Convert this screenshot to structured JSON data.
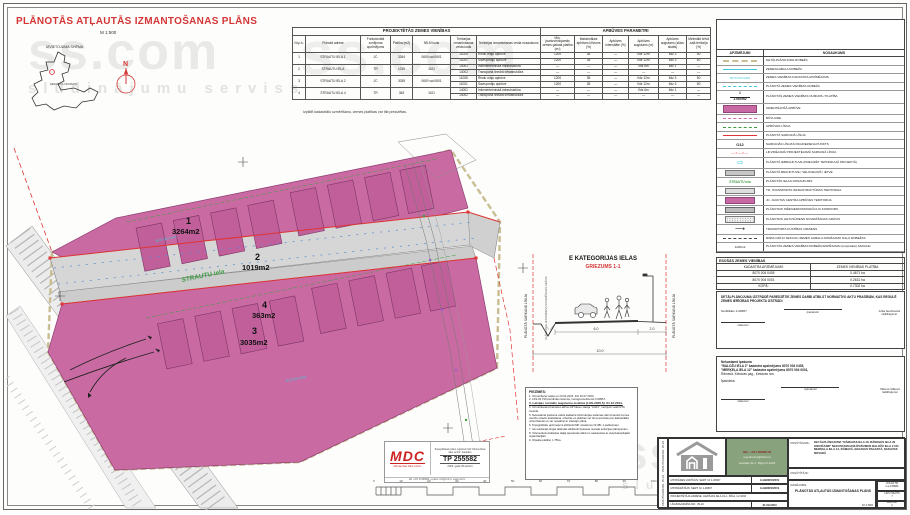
{
  "watermark": {
    "brand": "ss.com",
    "tagline": "sludinājumu serviss"
  },
  "header": {
    "title": "PLĀNOTĀS ATĻAUTĀS IZMANTOŠANAS PLĀNS",
    "scale": "M 1:500",
    "location_schema_label": "IZVIETOJUMA SHĒMA",
    "municipality_label": "ĶEKAVAS NOVADS",
    "north_label": "N"
  },
  "projected_table": {
    "title": "PROJEKTĒTĀS ZEMES VIENĪBAS",
    "params_title": "APBŪVES PARAMETRI",
    "columns": [
      "Nr.p.k.",
      "Plānotā adrese",
      "Funkcionālā zonējuma apzīmējums",
      "Platība (m2)",
      "NĪLM kods",
      "Teritorijas izmantošanas veida kods",
      "Teritorijas izmantošanas veida nosaukums"
    ],
    "param_columns": [
      "Min. jaunizveidojamās zemes gabala platība (m²)",
      "Maksimālais apbūves blīvums (%)",
      "Apbūves intensitāte (%)",
      "Apbūves augstums (m)",
      "Apbūves augstums (stāvu skaits)",
      "Minimālā brīvā zaļā teritorija (%)"
    ],
    "rows": [
      {
        "nr": "1",
        "adrese": "STRAUTU IELA 1",
        "zona": "JC",
        "platiba": "3264",
        "nilm": "0600 vai 0601",
        "lines": [
          [
            "11005",
            "Rindu māju apbūve",
            "1200",
            "35",
            "—",
            "līdz 12m",
            "līdz 3",
            "50"
          ],
          [
            "11001",
            "Savrupmāju apbūve",
            "1200",
            "35",
            "—",
            "līdz 12m",
            "līdz 3",
            "50"
          ]
        ]
      },
      {
        "nr": "2",
        "adrese": "STRAUTU IELA",
        "zona": "TR",
        "platiba": "1019",
        "nilm": "1101",
        "lines": [
          [
            "14001",
            "Inženiertehniskā infrastruktūra",
            "—",
            "—",
            "—",
            "līdz 6m",
            "līdz 1",
            "—"
          ],
          [
            "14002",
            "Transporta lineārā infrastruktūra",
            "—",
            "—",
            "—",
            "—",
            "—",
            "—"
          ]
        ]
      },
      {
        "nr": "3",
        "adrese": "STRAUTU IELA 2",
        "zona": "JC",
        "platiba": "3035",
        "nilm": "0600 vai 0601",
        "lines": [
          [
            "11005",
            "Rindu māju apbūve",
            "1200",
            "35",
            "—",
            "līdz 12m",
            "līdz 3",
            "50"
          ],
          [
            "11001",
            "Savrupmāju apbūve",
            "1200",
            "35",
            "—",
            "līdz 12m",
            "līdz 3",
            "50"
          ]
        ]
      },
      {
        "nr": "4",
        "adrese": "STRAUTU IELA 4",
        "zona": "TR",
        "platiba": "363",
        "nilm": "1101",
        "lines": [
          [
            "14001",
            "Inženiertehniskā infrastruktūra",
            "—",
            "—",
            "—",
            "līdz 6m",
            "līdz 1",
            "—"
          ],
          [
            "14002",
            "Transporta lineārā infrastruktūra",
            "—",
            "—",
            "—",
            "—",
            "—",
            "—"
          ]
        ]
      }
    ],
    "footnote": "Izpildīt kadastrālo uzmērīšanu, zemes platības var tikt precizētas."
  },
  "legend": {
    "col_symbol": "APZĪMĒJUMI",
    "col_name": "NOSAUKUMS",
    "items": [
      {
        "sym": "dash-olive",
        "label": "DETĀLPLĀNOJUMA ROBEŽA"
      },
      {
        "sym": "line-cyan",
        "label": "ZEMESGABALA ROBEŽA"
      },
      {
        "sym": "text-cyan",
        "text": "8070 004 0405",
        "label": "ZEMES VIENĪBAS KADASTRA APZĪMĒJUMS"
      },
      {
        "sym": "dash-cyan",
        "label": "PLĀNOTĀ ZEMES VIENĪBAS ROBEŽA"
      },
      {
        "sym": "num-area",
        "text": "1",
        "text2": "1.060m2",
        "label": "PLĀNOTĀS ZEMES VIENĪBAS NUMURS / PLATĪBA"
      },
      {
        "sym": "rect-pink-big",
        "label": "ORIENTĒJOŠĀ APBŪVE"
      },
      {
        "sym": "dash-pink",
        "label": "BŪVLAIDE"
      },
      {
        "sym": "dashdot-green",
        "label": "APBŪVES LĪNIJA"
      },
      {
        "sym": "line-red",
        "label": "PLĀNOTĀ SARKANĀ LĪNIJA"
      },
      {
        "sym": "text-red",
        "text": "O12",
        "label": "SARKANĀS LĪNIJAS PAGRIEZIENA PUNKTS"
      },
      {
        "sym": "xdash-red",
        "text": "—×—×—",
        "label": "LIKVIDĒJAMĀ PROJEKTĒJAMĀ SARKANĀ LĪNIJA"
      },
      {
        "sym": "arrow-cyan",
        "text": "⇨",
        "label": "PLĀNOTĀ IEBRAUKTUVE (PRECIZĒT TEHNISKAJĀ PROJEKTĀ)"
      },
      {
        "sym": "rect-gray",
        "label": "PLĀNOTĀ BRAUKTUVE / VELOCELIŅŠ / IETVE"
      },
      {
        "sym": "text-green",
        "text": "STRAUTU iela",
        "label": "PLĀNOTĀS IELAS NOSAUKUMS"
      },
      {
        "sym": "rect-lightgray",
        "label": "TR, TRANSPORTA INFRASTRUKTŪRAS TERITORIJA"
      },
      {
        "sym": "rect-pink",
        "label": "JC, JAUKTAS CENTRA APBŪVES TERITORIJA"
      },
      {
        "sym": "rect-midgray",
        "label": "PLĀNOTAIS INŽENIERKOMUNIKĀCIJU KORIDORS"
      },
      {
        "sym": "rect-dotted",
        "label": "PLĀNOTAIS LIETUSŪDENS NOVADĪŠANAS GRĀVIS"
      },
      {
        "sym": "arrow-black",
        "text": "⟶",
        "label": "TRANSPORTA KUSTĪBAS VIRZIENS"
      },
      {
        "sym": "dash-black",
        "label": "RINDU MĀJU SEKCIJU ZEMES GABALA DOMĀJAMO DAĻU ROBEŽAS"
      },
      {
        "sym": "text-small",
        "text": "1200m2",
        "label": "PLĀNOTĀS ZEMES VIENĪBAS ROBEŽA IESPĒJAMAI (turpmākai) SADALEI"
      }
    ]
  },
  "existing_table": {
    "title": "ESOŠĀS ZEMES VIENĪBAS",
    "columns": [
      "KADASTRA APZĪMĒJUMS",
      "ZEMES VIENĪBAS PLATĪBA"
    ],
    "rows": [
      [
        "8070 004 0405",
        "0.4671 ha"
      ],
      [
        "8070 004 0001",
        "0.2631 ha"
      ],
      [
        "KOPĀ:",
        "0.7302 ha"
      ]
    ]
  },
  "statement_box": {
    "text": "DETĀLPLĀNOJUMA IZSTRĀDĒ PAREDZĒTIE ZEMES DARBI ATBILST NORMATĪVO AKTU PRASĪBĀM, KAS REGULĒ ZEMES IERĪCĪBAS PROJEKTA IZSTRĀDI",
    "certificate": "Sertifikāts 1-00667",
    "sign_label": "/paraksts/",
    "name": "Arita Gedrovica",
    "name_label": "/atšifrējums/",
    "date_label": "/datums/"
  },
  "owner_box": {
    "line1": "Nekustamā īpašuma",
    "line2": "\"BALOŽU IELA 2\" kadastra apzīmējums 8070 004 0405,",
    "line3": "\"MERĶEĻA IELA 12\" kadastra apzīmējums 8070 004 0001,",
    "line4": "Rāmavā, Ķekavas pag., Ķekavas nov.",
    "line5": "Īpašnieks:",
    "sign_label": "/paraksts/",
    "name": "Viktors Vilkovs",
    "name_label": "/atšifrējums/",
    "date_label": "/datums/"
  },
  "plan": {
    "parcels": [
      {
        "nr": "1",
        "area": "3264m2"
      },
      {
        "nr": "2",
        "area": "1019m2"
      },
      {
        "nr": "3",
        "area": "3035m2"
      },
      {
        "nr": "4",
        "area": "363m2"
      }
    ],
    "street_name": "STRAUTU iela",
    "cadastre_labels": [
      "8070 004 0405",
      "8070 004 0001"
    ]
  },
  "section": {
    "title": "E KATEGORIJAS IELAS",
    "subtitle": "GRIEZUMS 1-1",
    "red_line_label": "PLĀNOTĀ SARKANĀ LĪNIJA",
    "ditch_label": "PLĀNOTAIS LIETUSŪDENS NOVADĪŠANAS GRĀVIS",
    "dims": {
      "carriageway": "6.0",
      "side": "2.0",
      "total": "10.0"
    }
  },
  "notes": {
    "title": "PIEZĪMES:",
    "items": [
      "Uzmērīšana veikta no 23.02.2023. līdz 16.07.2023.",
      "LKS-92 TM koordinātu sistēma, mēroga koeficients 0.99957.",
      "Latvijas normālo augstumu sistēma (LAS-2000,5). 01.12.2014.",
      "Uzmērīšanā izmantota LatPos GP bāzes stacija \"LG04\", mērījumi veikti RTK metodē.",
      "Nekustamā īpašuma valsts kadastra informācijas sistēmas dati izmantoti zemes vienību robežu attēlošanai, robežas un platības var tikt precizētas pēc kadastrālās uzmērīšanas un var nesakrist ar situāciju plānā.",
      "Topogrāfiskie apzīmējumi atbilstoši MK noteikumu Nr.281 1.pielikumam.",
      "Ielu sarkanās līnijas attēlotas atbilstoši Ķekavas novada teritorijas plānojumam.",
      "Inženierkomunikācijas daļēji apsekotas dabā un saskaņotas ar ekspluatējošajām organizācijām.",
      "Objekta platība: 1.75ha."
    ]
  },
  "stamp": {
    "logo": "MDC",
    "logo_sub": "Mērniecības Datu Centrs",
    "reg_text": "Topogrāfiskais plāns reģistrēts SIA \"Mērniecības datu centrs\" datubāzē",
    "number": "TP 255582",
    "date": "2023. gada 06.oktobrī",
    "contact": "tālr. +371 67496833, e-pasts: info@mdc.lv, www.mdc.lv"
  },
  "scalebar": {
    "labels": [
      "0",
      "10",
      "20",
      "30",
      "40",
      "50",
      "60",
      "70",
      "80",
      "90",
      "100 m"
    ]
  },
  "titleblock": {
    "side_label": "PASŪTĪJUMA NR. 35-24",
    "contact": {
      "line1": "tālr.: +371 29326143",
      "line2": "a.gedrovics@inbox.lv",
      "line3": "Liepājas 31-1, Rīga LV-1002"
    },
    "rows": [
      {
        "label": "IZSTRĀDES VADĪTĀJS: SERT. Nr 1-00667",
        "value": "A.GEDROVICS"
      },
      {
        "label": "IZSTRĀDĀTĀJS: SERT. Nr 1-00667",
        "value": "A.GEDROVICS"
      },
      {
        "label": "PROJEKTĒTĀJA ADRESE: LIEPĀJAS IELA 31-1, RĪGA, LV-1002",
        "value": ""
      },
      {
        "label": "LĪGUMA/ARHĪVA NR.: 35-24",
        "value": "31.09.2024"
      }
    ],
    "order_label": "PASŪTĪJUMS:",
    "order_text": "DETĀLPLĀNOJUMA \"RĀMAVAS IELA 18, RĀMAVAS IELA 20 GROZĪJUMI\" NEKUSTAMAJOS ĪPAŠUMOS BALOŽU IELA 2 UN MERĶEĻA IELA 12, RĀMAVĀ, ĶEKAVAS PAGASTĀ, ĶEKAVAS NOVADĀ",
    "client_label": "PASŪTĪTĀJS:",
    "drawing_label": "RASĒJUMS:",
    "drawing_title": "PLĀNOTĀS ATĻAUTĀS IZMANTOŠANAS PLĀNS",
    "drawing_scale": "M 1:500",
    "coord": "LKS-92 TM",
    "coord2": "m.a 0.99961",
    "sheets_label": "LAPU SKAITS",
    "sheets": "7",
    "sheet_label": "LAPA NR.",
    "sheet": "2"
  }
}
